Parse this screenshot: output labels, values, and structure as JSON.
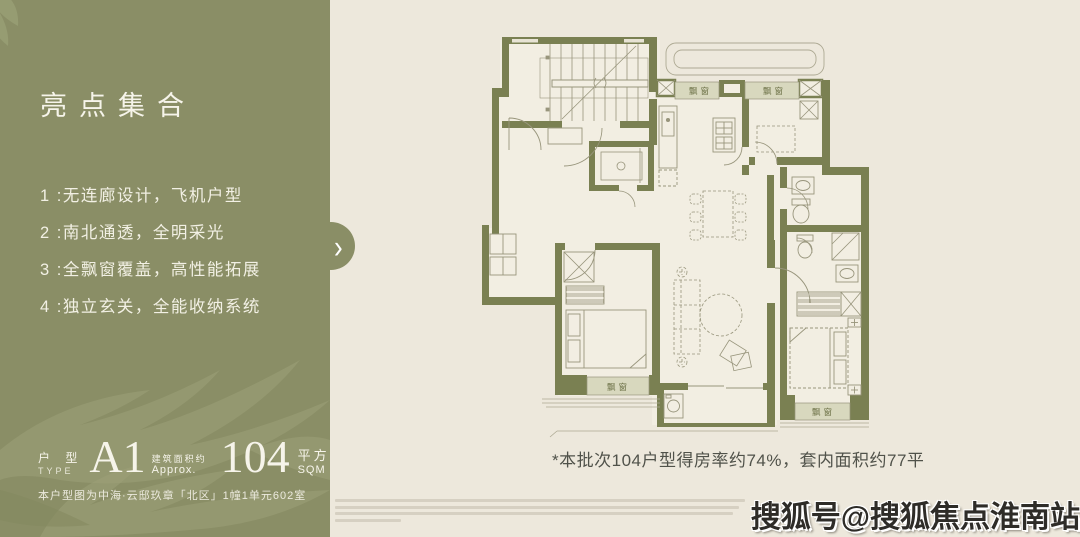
{
  "sidebar": {
    "title": "亮点集合",
    "highlights": [
      "1 :无连廊设计，飞机户型",
      "2 :南北通透，全明采光",
      "3 :全飘窗覆盖，高性能拓展",
      "4 :独立玄关，全能收纳系统"
    ],
    "unit": {
      "type_label_cn": "户 型",
      "type_label_en": "TYPE",
      "type_value": "A1",
      "area_label_cn": "建筑面积约",
      "area_label_en": "Approx.",
      "area_value": "104",
      "area_unit_cn": "平方米",
      "area_unit_en": "SQM"
    },
    "note": "本户型图为中海·云邸玖章「北区」1幢1单元602室"
  },
  "nav": {
    "next_icon": "›"
  },
  "floorplan": {
    "bay_window_labels": [
      "飘窗",
      "飘窗",
      "飘窗",
      "飘窗"
    ],
    "caption": "*本批次104户型得房率约74%，套内面积约77平"
  },
  "watermark": {
    "text": "搜狐号@搜狐焦点淮南站"
  },
  "colors": {
    "sidebar_olive": "#8A8E66",
    "wall_olive": "#7A8052",
    "background_cream": "#EDE8DC",
    "plan_floor": "#F2EEE2",
    "bay_window_fill": "#D8D8BE",
    "highlight_text": "#F2F0E4"
  }
}
